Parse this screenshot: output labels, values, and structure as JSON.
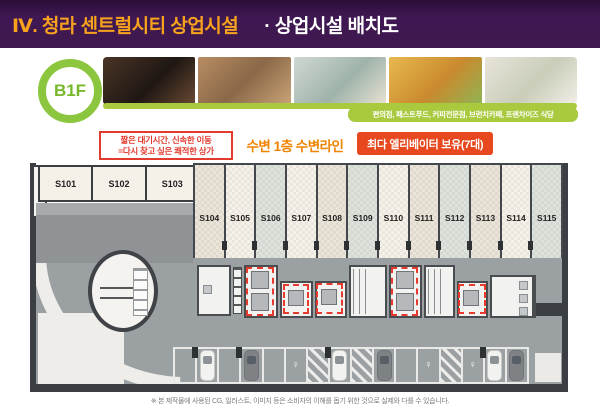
{
  "header": {
    "title_main": "Ⅳ. 청라 센트럴시티 상업시설",
    "title_sub": "· 상업시설 배치도"
  },
  "floor_badge": {
    "label": "B1F"
  },
  "photos": {
    "items": [
      "cafe-espresso-machine",
      "people-at-cafe",
      "convenience-store",
      "fried-chicken",
      "restaurant-dining"
    ],
    "caption": "편의점, 패스트푸드, 커피전문점, 브런치카페, 프랜차이즈 식당"
  },
  "callouts": {
    "benefit_line1": "짧은 대기시간, 신속한 이동",
    "benefit_line2": "=다시 찾고 싶은 쾌적한 상가",
    "waterside": "수변 1층 수변라인",
    "elevator": "최다 엘리베이터 보유(7대)"
  },
  "plan": {
    "units_top": [
      "S101",
      "S102",
      "S103"
    ],
    "units_main": [
      "S104",
      "S105",
      "S106",
      "S107",
      "S108",
      "S109",
      "S110",
      "S111",
      "S112",
      "S113",
      "S114",
      "S115"
    ],
    "highlighted_elevator_count": 7
  },
  "icons": {
    "ev_glyph": "♀"
  },
  "footer": {
    "disclaimer": "※ 본 제작물에 사용된 CG, 일러스트, 이미지 등은 소비자의 이해를 돕기 위한 것으로 실제와 다를 수 있습니다."
  },
  "colors": {
    "header_bg": "#3f1752",
    "title_orange": "#f6a21d",
    "badge_green": "#8cc63e",
    "caption_green": "#a9c93f",
    "benefit_red": "#e23b2e",
    "waterside_orange": "#f08300",
    "elevator_pill_bg": "#e8481d",
    "plan_wall": "#3b3e42",
    "corridor_gray": "#9ba0a3",
    "highlight_dash_red": "#e8392e"
  }
}
